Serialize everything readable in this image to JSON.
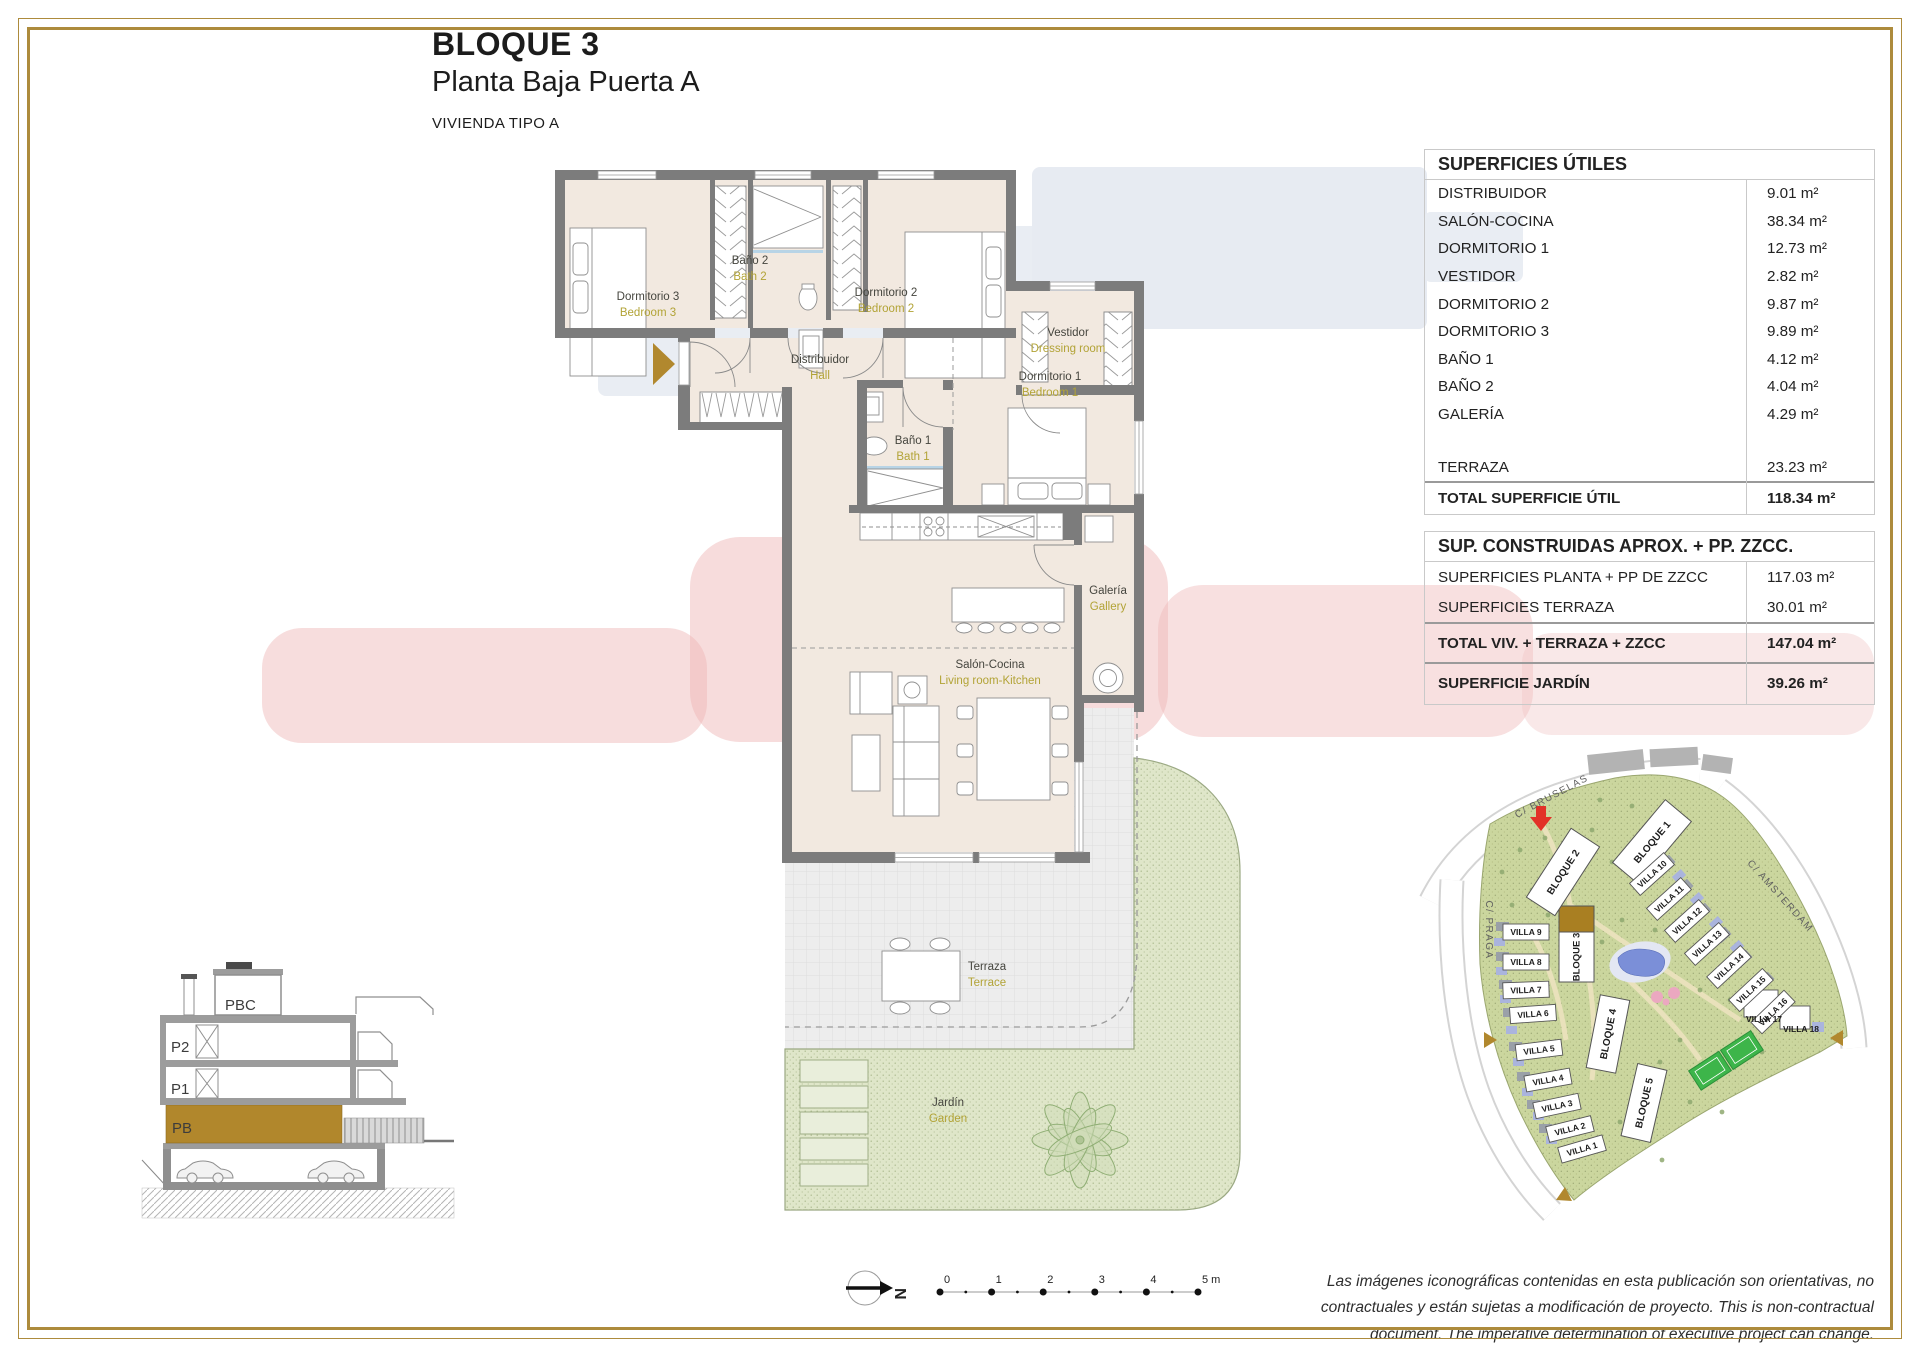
{
  "title_block": {
    "title": "BLOQUE 3",
    "subtitle": "Planta Baja Puerta A",
    "type_label": "VIVIENDA TIPO A"
  },
  "colors": {
    "border_gold": "#ad8b3c",
    "accent_gold": "#b1872c",
    "label_olive": "#b2a336",
    "wall_gray": "#7c7c7c",
    "room_beige": "#f2e9e0",
    "garden_green": "#dfe6c9",
    "site_green": "#cbd69e",
    "pool_blue": "#7b8fd8",
    "entrance_red": "#e23128"
  },
  "tables": {
    "superficies_utiles": {
      "title": "SUPERFICIES ÚTILES",
      "rows": [
        {
          "label": "DISTRIBUIDOR",
          "value": "9.01 m²"
        },
        {
          "label": "SALÓN-COCINA",
          "value": "38.34 m²"
        },
        {
          "label": "DORMITORIO 1",
          "value": "12.73 m²"
        },
        {
          "label": "VESTIDOR",
          "value": "2.82 m²"
        },
        {
          "label": "DORMITORIO 2",
          "value": "9.87 m²"
        },
        {
          "label": "DORMITORIO 3",
          "value": "9.89 m²"
        },
        {
          "label": "BAÑO 1",
          "value": "4.12 m²"
        },
        {
          "label": "BAÑO 2",
          "value": "4.04 m²"
        },
        {
          "label": "GALERÍA",
          "value": "4.29 m²"
        },
        {
          "label": "TERRAZA",
          "value": "23.23 m²"
        }
      ],
      "totals": [
        {
          "label": "TOTAL SUPERFICIE ÚTIL",
          "value": "118.34 m²"
        }
      ]
    },
    "sup_construidas": {
      "title": "SUP. CONSTRUIDAS APROX. + PP. ZZCC.",
      "rows": [
        {
          "label": "SUPERFICIES PLANTA + PP DE ZZCC",
          "value": "117.03 m²"
        },
        {
          "label": "SUPERFICIES TERRAZA",
          "value": "30.01 m²"
        }
      ],
      "totals": [
        {
          "label": "TOTAL VIV. + TERRAZA + ZZCC",
          "value": "147.04 m²"
        },
        {
          "label": "SUPERFICIE JARDÍN",
          "value": "39.26 m²"
        }
      ]
    }
  },
  "floor_plan": {
    "rooms": [
      {
        "es": "Dormitorio 3",
        "en": "Bedroom 3"
      },
      {
        "es": "Baño 2",
        "en": "Bath 2"
      },
      {
        "es": "Dormitorio 2",
        "en": "Bedroom 2"
      },
      {
        "es": "Vestidor",
        "en": "Dressing room"
      },
      {
        "es": "Distribuidor",
        "en": "Hall"
      },
      {
        "es": "Dormitorio 1",
        "en": "Bedroom 1"
      },
      {
        "es": "Baño 1",
        "en": "Bath 1"
      },
      {
        "es": "Galería",
        "en": "Gallery"
      },
      {
        "es": "Salón-Cocina",
        "en": "Living room-Kitchen"
      },
      {
        "es": "Terraza",
        "en": "Terrace"
      },
      {
        "es": "Jardín",
        "en": "Garden"
      }
    ]
  },
  "section_diagram": {
    "levels": [
      "PBC",
      "P2",
      "P1",
      "PB"
    ]
  },
  "site_plan": {
    "streets": [
      "C/ BRUSELAS",
      "C/ PRAGA",
      "C/ AMSTERDAM"
    ],
    "blocks": [
      "BLOQUE 1",
      "BLOQUE 2",
      "BLOQUE 3",
      "BLOQUE 4",
      "BLOQUE 5"
    ],
    "villas": [
      "VILLA 1",
      "VILLA 2",
      "VILLA 3",
      "VILLA 4",
      "VILLA 5",
      "VILLA 6",
      "VILLA 7",
      "VILLA 8",
      "VILLA 9",
      "VILLA 10",
      "VILLA 11",
      "VILLA 12",
      "VILLA 13",
      "VILLA 14",
      "VILLA 15",
      "VILLA 16",
      "VILLA 17",
      "VILLA 18"
    ]
  },
  "scale_bar": {
    "north_letter": "N",
    "ticks": [
      "0",
      "1",
      "2",
      "3",
      "4",
      "5 m"
    ]
  },
  "disclaimer": "Las imágenes iconográficas contenidas en esta publicación son orientativas, no contractuales y están sujetas a modificación de proyecto. This is non-contractual document. The imperative determination of executive project can change."
}
